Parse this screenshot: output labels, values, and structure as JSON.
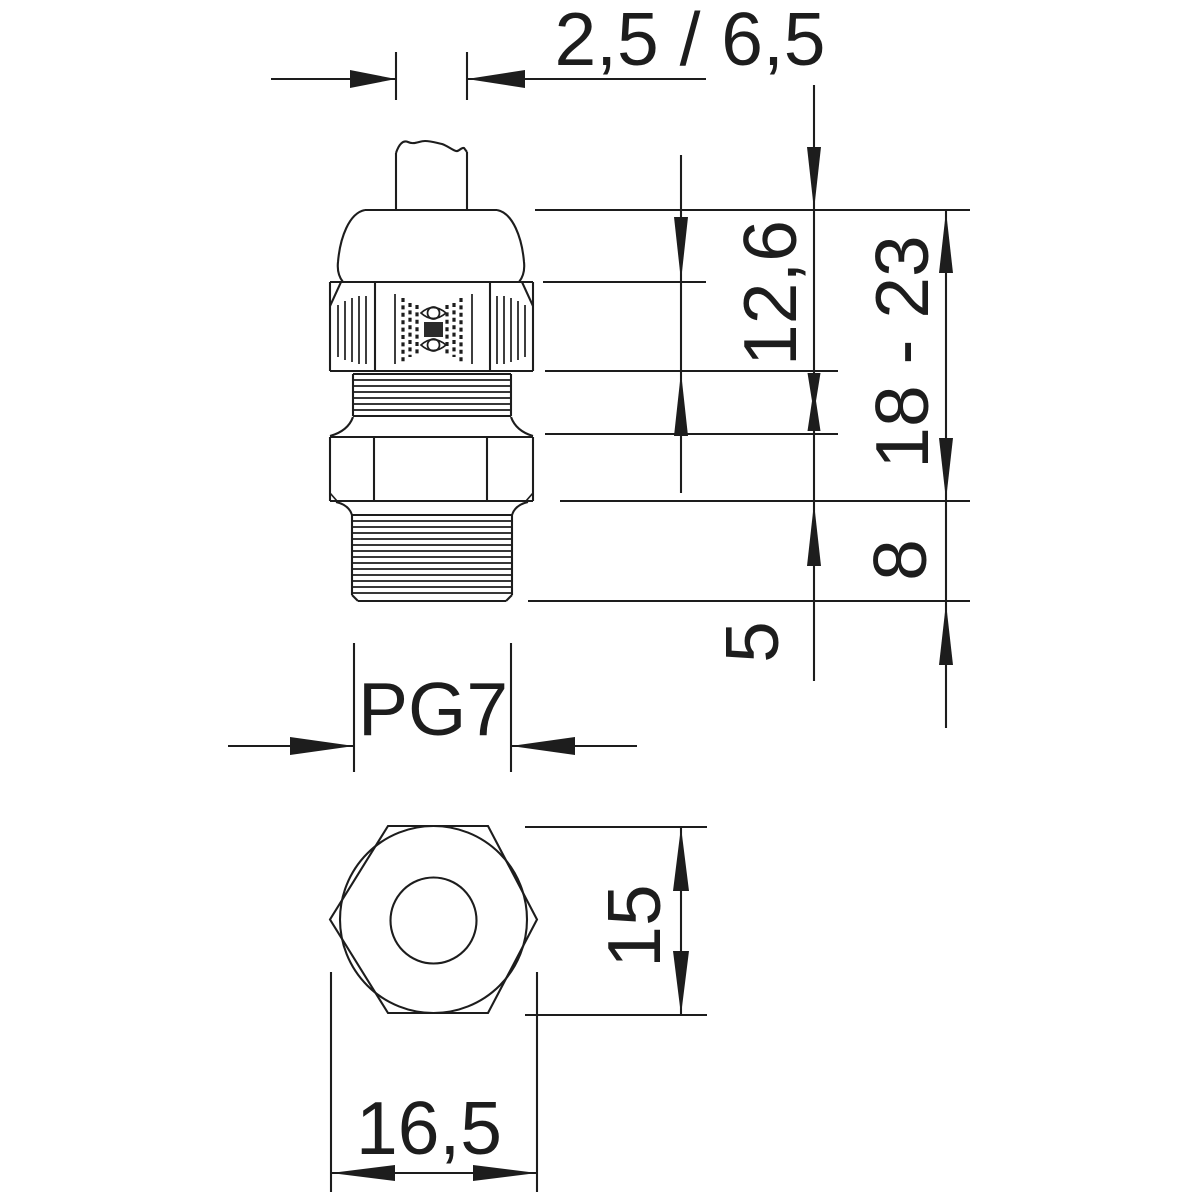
{
  "drawing": {
    "kind": "technical dimension drawing, cable gland, two views",
    "background_color": "#ffffff",
    "line_color": "#1d1d1d"
  },
  "annotations": {
    "top_width": "2,5 / 6,5",
    "right_upper": "12,6",
    "right_overall": "18 - 23",
    "right_mid": "8",
    "right_lower": "5",
    "thread": "PG7",
    "bottom_view_across_flats": "15",
    "bottom_view_width": "16,5"
  }
}
